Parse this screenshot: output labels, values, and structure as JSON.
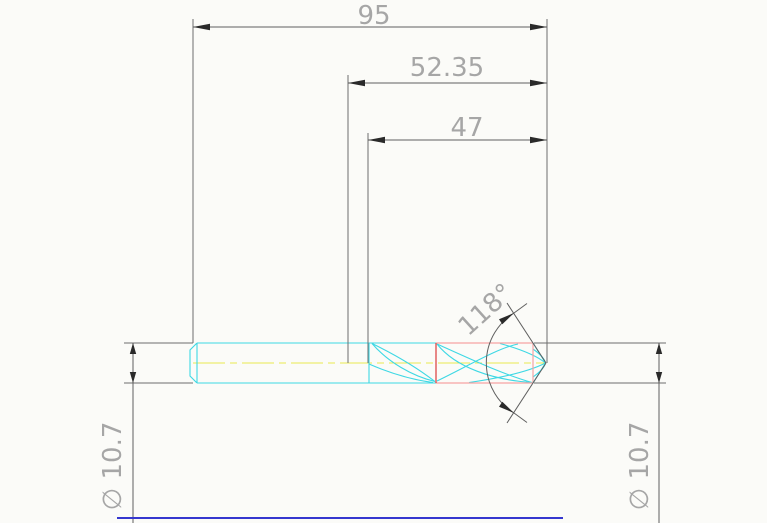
{
  "drawing": {
    "type": "CAD technical drawing",
    "subject": "twist drill, side elevation view",
    "dimensions": {
      "overall_length": "95",
      "mid_length": "52.35",
      "flute_length": "47",
      "point_angle": "118°",
      "diameter_left": "∅ 10.7",
      "diameter_right": "∅ 10.7"
    },
    "colors": {
      "background": "#fbfbf8",
      "dimension_lines": "#5f5f5f",
      "extension_lines": "#6e6e6e",
      "dimension_text": "#a6a6a6",
      "arrowheads": "#2a2a2a",
      "drill_outline_cyan": "#3ed8e4",
      "highlight_red": "#dd3b3b",
      "highlight_salmon": "#f5a3a3",
      "centerline_yellow": "#e9e94f",
      "bottom_frame_blue": "#3537cf"
    }
  }
}
